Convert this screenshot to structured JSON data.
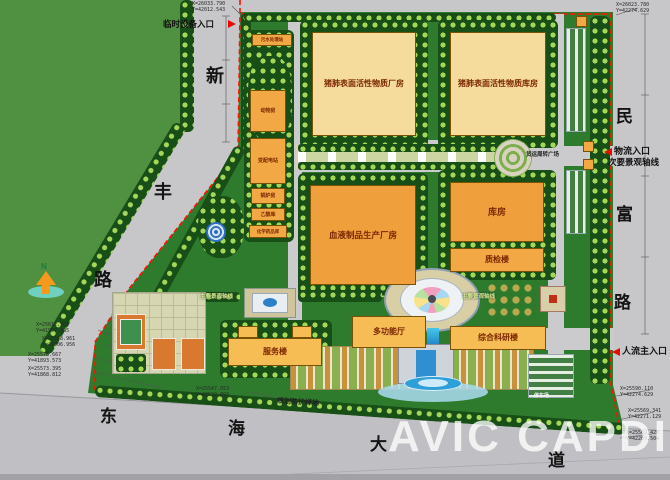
{
  "map": {
    "watermark": "AVIC  CAPDI",
    "north_label": "N",
    "roads": {
      "xinfeng": [
        "新",
        "丰",
        "路"
      ],
      "minfu": [
        "民",
        "富",
        "路"
      ],
      "donghai": [
        "东",
        "海",
        "大",
        "道"
      ]
    },
    "entrances": {
      "temp_equipment": "临时设备入口",
      "logistics": "物流入口",
      "main_pedestrian": "人流主入口"
    },
    "axes": {
      "main": "主要景观轴线",
      "secondary": "次要景观轴线"
    },
    "areas": {
      "freight_plaza": "货运周转广场",
      "parking": "停车场",
      "green_belt": "规划防护绿地"
    },
    "buildings": {
      "sewage": "污水处理站",
      "animal": "动物房",
      "substation": "变配电站",
      "boiler": "锅炉房",
      "ethanol": "乙醇库",
      "chemical": "化学药品库",
      "surfactant_plant": "猪肺表面活性物质厂房",
      "surfactant_warehouse": "猪肺表面活性物质库房",
      "blood_plant": "血液制品生产厂房",
      "warehouse": "库房",
      "qc": "质检楼",
      "multi_hall": "多功能厅",
      "research": "综合科研楼",
      "service": "服务楼"
    },
    "coords": [
      {
        "x": "X=26033.790",
        "y": "Y=42012.543"
      },
      {
        "x": "X=26023.780",
        "y": "Y=42274.629"
      },
      {
        "x": "X=25612.365",
        "y": "Y=41907.945"
      },
      {
        "x": "X=25598.961",
        "y": "Y=41906.956"
      },
      {
        "x": "X=25576.667",
        "y": "Y=41893.573"
      },
      {
        "x": "X=25573.395",
        "y": "Y=41868.812"
      },
      {
        "x": "X=25547.053",
        "y": "Y=42532.893"
      },
      {
        "x": "X=25590.110",
        "y": "Y=42274.629"
      },
      {
        "x": "X=25569.341",
        "y": "Y=42271.129"
      },
      {
        "x": "X=25569.420",
        "y": "Y=42269.504"
      }
    ],
    "colors": {
      "boundary": "#ff1200",
      "building_cream": "#f6dc9c",
      "building_orange": "#f2a945",
      "site_green": "#2e7b2e",
      "offsite_green": "#4f9140"
    }
  }
}
